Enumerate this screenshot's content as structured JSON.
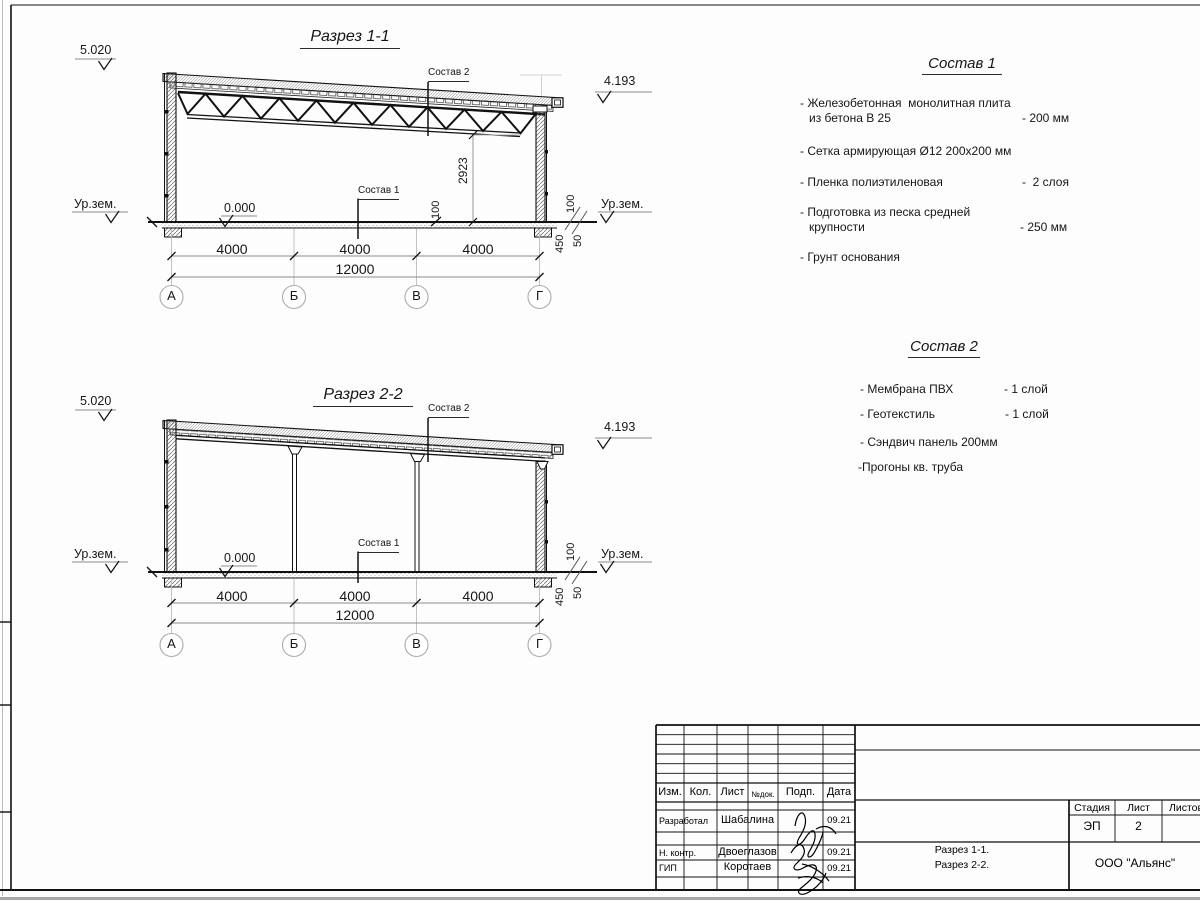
{
  "section1": {
    "title": "Разрез 1-1",
    "elev_left": "5.020",
    "elev_right": "4.193",
    "ground_label": "Ур.зем.",
    "zero_level": "0.000",
    "callout_roof": "Состав 2",
    "callout_floor": "Состав 1",
    "dim_height": "2923",
    "dim_100": "100",
    "dim_450": "450",
    "dim_50": "50",
    "dim_bay": "4000",
    "dim_total": "12000",
    "axes": [
      "А",
      "Б",
      "В",
      "Г"
    ]
  },
  "section2": {
    "title": "Разрез 2-2",
    "elev_left": "5.020",
    "elev_right": "4.193",
    "ground_label": "Ур.зем.",
    "zero_level": "0.000",
    "callout_roof": "Состав 2",
    "callout_floor": "Состав 1",
    "dim_100": "100",
    "dim_450": "450",
    "dim_50": "50",
    "dim_bay": "4000",
    "dim_total": "12000",
    "axes": [
      "А",
      "Б",
      "В",
      "Г"
    ]
  },
  "composition1": {
    "title": "Состав 1",
    "item1_line1": "- Железобетонная  монолитная плита",
    "item1_line2": "из бетона В 25",
    "item1_value": "- 200 мм",
    "item2": "- Сетка армирующая Ø12 200х200 мм",
    "item3": "- Пленка полиэтиленовая",
    "item3_value": "-  2 слоя",
    "item4_line1": "- Подготовка из песка средней",
    "item4_line2": "крупности",
    "item4_value": "- 250 мм",
    "item5": "- Грунт основания"
  },
  "composition2": {
    "title": "Состав 2",
    "item1": "- Мембрана ПВХ",
    "item1_value": "- 1 слой",
    "item2": "- Геотекстиль",
    "item2_value": "- 1 слой",
    "item3": "- Сэндвич панель 200мм",
    "item4": "-Прогоны кв. труба"
  },
  "titleblock": {
    "col_izm": "Изм.",
    "col_kol": "Кол.",
    "col_list": "Лист",
    "col_ndok": "№док.",
    "col_podp": "Подп.",
    "col_data": "Дата",
    "row1_role": "Разработал",
    "row1_name": "Шабалина",
    "row1_date": "09.21",
    "row2_role": "Н. контр.",
    "row2_name": "Двоеглазов",
    "row2_date": "09.21",
    "row3_role": "ГИП",
    "row3_name": "Коротаев",
    "row3_date": "09.21",
    "stage_label": "Стадия",
    "sheet_label": "Лист",
    "sheets_label": "Листов",
    "stage_value": "ЭП",
    "sheet_value": "2",
    "content_line1": "Разрез 1-1.",
    "content_line2": "Разрез 2-2.",
    "company": "ООО \"Альянс\""
  }
}
